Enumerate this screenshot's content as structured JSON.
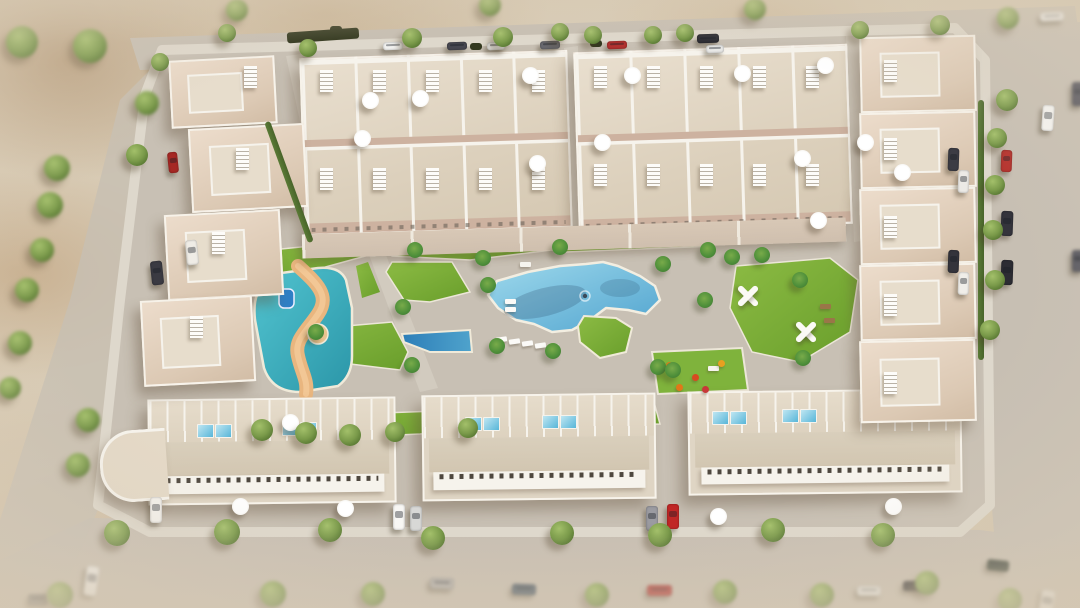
{
  "meta": {
    "title": "Aerial 3D render of a residential complex",
    "type": "architectural-visualization",
    "no_visible_text": true
  },
  "scene": {
    "description": "Bird's-eye 3D render of a gated residential development: beige townhouse rows at the top, staggered villas on the left and right edges, three long apartment blocks at the bottom, all around a central landscaped courtyard with a large lagoon-shaped pool, a turquoise kids splash pool with winding sand river and water slide, lawns with palm trees, a playground, white exercise pergolas, and perimeter streets with parked cars and trees on sandy terrain.",
    "areas": {
      "main_pool": "Large zigzag-edged communal swimming pool with tanning shelf and planted island",
      "kids_pool": "Turquoise splash lagoon with sand-colored winding river and blue water slide",
      "lap_pool": "Small dark-blue wedge pool",
      "lawns": "Green lawn patches with palm trees",
      "playground": "Playground with orange play equipment",
      "calisthenics": "White X-shaped exercise pergolas on lawn",
      "solariums": "Rooftop terraces with parasols, sun loungers and plunge pools",
      "roads": "Perimeter streets with parked cars and street trees"
    }
  },
  "colors": {
    "sand": "#d6c8b1",
    "sandDark": "#bda184",
    "road": "#c7bfb3",
    "roadLight": "#d2cabe",
    "plate": "#c8c0b4",
    "sidewalk": "#ded8cc",
    "street": "#d2cbbf",
    "building": "#e4dac9",
    "buildingLight": "#efe8db",
    "terrace": "#cdb2a0",
    "white": "#f6f3ec",
    "lawn": "#7fb23a",
    "lawnDark": "#699e2b",
    "pool": "#7cc0e0",
    "poolDeep": "#4f9fc9",
    "lagoon": "#3fb7c4",
    "river": "#e9b67f",
    "tree": "#7a9a4a",
    "palm": "#4e8f3a",
    "shadow": "rgba(95,75,55,.38)"
  },
  "buildings": {
    "top_blocks": [
      {
        "x": 302,
        "y": 54,
        "w": 264,
        "h": 174,
        "units": 5
      },
      {
        "x": 576,
        "y": 48,
        "w": 270,
        "h": 176,
        "units": 5
      }
    ],
    "patio_band": {
      "x": 302,
      "y": 226,
      "w": 544,
      "h": 24
    },
    "bottom_blocks": [
      {
        "x": 148,
        "y": 398,
        "w": 244,
        "h": 102
      },
      {
        "x": 422,
        "y": 394,
        "w": 230,
        "h": 102
      },
      {
        "x": 688,
        "y": 390,
        "w": 270,
        "h": 100
      }
    ],
    "left_villas": [
      {
        "x": 170,
        "y": 58,
        "w": 102,
        "h": 64
      },
      {
        "x": 190,
        "y": 126,
        "w": 112,
        "h": 80
      },
      {
        "x": 166,
        "y": 212,
        "w": 112,
        "h": 82
      },
      {
        "x": 142,
        "y": 298,
        "w": 108,
        "h": 82
      }
    ],
    "right_villas": [
      {
        "x": 860,
        "y": 36,
        "w": 112,
        "h": 72
      },
      {
        "x": 860,
        "y": 112,
        "w": 112,
        "h": 72
      },
      {
        "x": 860,
        "y": 188,
        "w": 112,
        "h": 72
      },
      {
        "x": 860,
        "y": 264,
        "w": 112,
        "h": 72
      },
      {
        "x": 860,
        "y": 340,
        "w": 112,
        "h": 78
      }
    ],
    "curved_end": {
      "x": 100,
      "y": 430,
      "w": 64,
      "h": 66
    }
  },
  "objects": {
    "trees_format": "[x,y,radius,blurred]",
    "trees": [
      [
        22,
        42,
        16,
        1
      ],
      [
        90,
        46,
        17,
        1
      ],
      [
        57,
        168,
        13,
        1
      ],
      [
        147,
        103,
        12,
        1
      ],
      [
        137,
        155,
        11,
        0
      ],
      [
        50,
        205,
        13,
        1
      ],
      [
        42,
        250,
        12,
        1
      ],
      [
        27,
        290,
        12,
        1
      ],
      [
        20,
        343,
        12,
        1
      ],
      [
        10,
        388,
        11,
        1
      ],
      [
        88,
        420,
        12,
        1
      ],
      [
        78,
        465,
        12,
        1
      ],
      [
        60,
        595,
        13,
        1
      ],
      [
        237,
        10,
        11,
        1
      ],
      [
        490,
        5,
        11,
        1
      ],
      [
        755,
        9,
        11,
        1
      ],
      [
        940,
        25,
        10,
        0
      ],
      [
        1008,
        18,
        11,
        1
      ],
      [
        227,
        33,
        9,
        0
      ],
      [
        412,
        38,
        10,
        0
      ],
      [
        503,
        37,
        10,
        0
      ],
      [
        560,
        32,
        9,
        0
      ],
      [
        593,
        35,
        9,
        0
      ],
      [
        653,
        35,
        9,
        0
      ],
      [
        685,
        33,
        9,
        0
      ],
      [
        160,
        62,
        9,
        0
      ],
      [
        308,
        48,
        9,
        0
      ],
      [
        860,
        30,
        9,
        0
      ],
      [
        1007,
        100,
        11,
        0
      ],
      [
        997,
        138,
        10,
        0
      ],
      [
        995,
        185,
        10,
        0
      ],
      [
        993,
        230,
        10,
        0
      ],
      [
        995,
        280,
        10,
        0
      ],
      [
        990,
        330,
        10,
        0
      ],
      [
        117,
        533,
        13,
        0
      ],
      [
        227,
        532,
        13,
        0
      ],
      [
        330,
        530,
        12,
        0
      ],
      [
        433,
        538,
        12,
        0
      ],
      [
        562,
        533,
        12,
        0
      ],
      [
        660,
        535,
        12,
        0
      ],
      [
        773,
        530,
        12,
        0
      ],
      [
        883,
        535,
        12,
        0
      ],
      [
        273,
        594,
        13,
        1
      ],
      [
        373,
        594,
        12,
        1
      ],
      [
        597,
        595,
        12,
        1
      ],
      [
        725,
        592,
        12,
        1
      ],
      [
        822,
        595,
        12,
        1
      ],
      [
        927,
        583,
        12,
        1
      ],
      [
        1010,
        600,
        12,
        1
      ],
      [
        262,
        430,
        11,
        0
      ],
      [
        306,
        433,
        11,
        0
      ],
      [
        350,
        435,
        11,
        0
      ],
      [
        395,
        432,
        10,
        0
      ],
      [
        468,
        428,
        10,
        0
      ]
    ],
    "palms": [
      [
        415,
        250
      ],
      [
        483,
        258
      ],
      [
        560,
        247
      ],
      [
        488,
        285
      ],
      [
        403,
        307
      ],
      [
        412,
        365
      ],
      [
        497,
        346
      ],
      [
        553,
        351
      ],
      [
        663,
        264
      ],
      [
        658,
        367
      ],
      [
        673,
        370
      ],
      [
        708,
        250
      ],
      [
        732,
        257
      ],
      [
        762,
        255
      ],
      [
        800,
        280
      ],
      [
        803,
        358
      ],
      [
        705,
        300
      ],
      [
        316,
        332
      ]
    ],
    "cars_format": "[x,y,w,h,color,rotationDeg,blurred]",
    "cars": [
      [
        383,
        42,
        20,
        8,
        "#f2f2f0",
        -2,
        0
      ],
      [
        447,
        42,
        20,
        8,
        "#474750",
        -2,
        0
      ],
      [
        487,
        42,
        18,
        8,
        "#ececea",
        -2,
        0
      ],
      [
        540,
        41,
        20,
        8,
        "#6a6a70",
        -2,
        0
      ],
      [
        607,
        41,
        20,
        8,
        "#b23230",
        -2,
        0
      ],
      [
        697,
        34,
        22,
        9,
        "#2e2e34",
        -2,
        0
      ],
      [
        706,
        45,
        18,
        8,
        "#e8e8e6",
        -2,
        0
      ],
      [
        1040,
        12,
        24,
        9,
        "#f4f4f2",
        -3,
        1
      ],
      [
        1042,
        105,
        12,
        26,
        "#f6f6f4",
        4,
        0
      ],
      [
        1001,
        150,
        11,
        22,
        "#b5312c",
        2,
        0
      ],
      [
        1001,
        211,
        12,
        25,
        "#34343c",
        2,
        0
      ],
      [
        1001,
        260,
        12,
        25,
        "#2c2c33",
        2,
        0
      ],
      [
        1072,
        82,
        12,
        24,
        "#50505a",
        0,
        1
      ],
      [
        1072,
        250,
        12,
        22,
        "#5a5a62",
        0,
        1
      ],
      [
        168,
        152,
        10,
        21,
        "#a62824",
        -6,
        0
      ],
      [
        186,
        240,
        12,
        25,
        "#efece6",
        -6,
        0
      ],
      [
        151,
        261,
        12,
        24,
        "#3a3a42",
        -6,
        0
      ],
      [
        948,
        148,
        11,
        23,
        "#3c3c44",
        2,
        0
      ],
      [
        958,
        170,
        11,
        23,
        "#eceae6",
        2,
        0
      ],
      [
        948,
        250,
        11,
        23,
        "#34343c",
        2,
        0
      ],
      [
        958,
        272,
        11,
        23,
        "#f0eee9",
        2,
        0
      ],
      [
        150,
        497,
        12,
        26,
        "#f4f2ee",
        0,
        0
      ],
      [
        393,
        504,
        12,
        26,
        "#f8f7f4",
        0,
        0
      ],
      [
        410,
        506,
        12,
        25,
        "#d8d8d6",
        0,
        0
      ],
      [
        646,
        506,
        12,
        25,
        "#9b9ba1",
        0,
        0
      ],
      [
        667,
        504,
        12,
        25,
        "#c02726",
        0,
        0
      ],
      [
        85,
        566,
        13,
        30,
        "#f2f1ee",
        8,
        1
      ],
      [
        430,
        578,
        24,
        11,
        "#b2b0ae",
        2,
        1
      ],
      [
        512,
        584,
        24,
        11,
        "#4c5c6c",
        2,
        1
      ],
      [
        647,
        585,
        25,
        11,
        "#b43230",
        0,
        1
      ],
      [
        857,
        586,
        24,
        10,
        "#e9e9e7",
        0,
        1
      ],
      [
        903,
        581,
        24,
        10,
        "#26262a",
        0,
        1
      ],
      [
        987,
        560,
        22,
        11,
        "#2f3a30",
        6,
        1
      ],
      [
        1040,
        590,
        14,
        26,
        "#ececea",
        10,
        1
      ],
      [
        28,
        594,
        20,
        11,
        "#777777",
        0,
        1
      ]
    ],
    "umbrellas": [
      [
        370,
        100
      ],
      [
        420,
        98
      ],
      [
        530,
        75
      ],
      [
        362,
        138
      ],
      [
        537,
        163
      ],
      [
        632,
        75
      ],
      [
        742,
        73
      ],
      [
        602,
        142
      ],
      [
        802,
        158
      ],
      [
        825,
        65
      ],
      [
        818,
        220
      ],
      [
        865,
        142
      ],
      [
        902,
        172
      ],
      [
        290,
        422
      ],
      [
        345,
        508
      ],
      [
        718,
        516
      ],
      [
        893,
        506
      ],
      [
        240,
        506
      ]
    ],
    "loungers_format": "[x,y,rotationDeg]",
    "loungers": [
      [
        496,
        337,
        -8
      ],
      [
        509,
        339,
        -8
      ],
      [
        522,
        341,
        -8
      ],
      [
        535,
        343,
        -8
      ],
      [
        548,
        345,
        -8
      ],
      [
        505,
        299,
        0
      ],
      [
        505,
        307,
        0
      ]
    ],
    "mini_pools": [
      [
        197,
        424
      ],
      [
        215,
        424
      ],
      [
        282,
        422
      ],
      [
        300,
        422
      ],
      [
        465,
        417
      ],
      [
        483,
        417
      ],
      [
        542,
        415
      ],
      [
        560,
        415
      ],
      [
        712,
        411
      ],
      [
        730,
        411
      ],
      [
        782,
        409
      ],
      [
        800,
        409
      ]
    ],
    "stair_slats": [
      [
        320,
        70
      ],
      [
        373,
        70
      ],
      [
        426,
        70
      ],
      [
        479,
        70
      ],
      [
        532,
        70
      ],
      [
        320,
        168
      ],
      [
        373,
        168
      ],
      [
        426,
        168
      ],
      [
        479,
        168
      ],
      [
        532,
        168
      ],
      [
        594,
        66
      ],
      [
        647,
        66
      ],
      [
        700,
        66
      ],
      [
        753,
        66
      ],
      [
        806,
        66
      ],
      [
        594,
        164
      ],
      [
        647,
        164
      ],
      [
        700,
        164
      ],
      [
        753,
        164
      ],
      [
        806,
        164
      ],
      [
        244,
        66
      ],
      [
        236,
        148
      ],
      [
        212,
        232
      ],
      [
        190,
        316
      ],
      [
        884,
        60
      ],
      [
        884,
        138
      ],
      [
        884,
        216
      ],
      [
        884,
        294
      ],
      [
        884,
        372
      ]
    ],
    "hedges_format": "[x,y,w,h,rotationDeg,dark]",
    "hedges": [
      [
        287,
        30,
        72,
        11,
        -4,
        1
      ],
      [
        286,
        118,
        6,
        128,
        -20,
        0
      ],
      [
        978,
        100,
        6,
        260,
        0,
        0
      ],
      [
        470,
        43,
        12,
        7,
        0,
        1
      ],
      [
        590,
        40,
        12,
        7,
        0,
        1
      ],
      [
        330,
        26,
        12,
        7,
        0,
        1
      ]
    ],
    "benches_format": "[x,y,color]",
    "benches": [
      [
        520,
        262,
        "#f6f4ee"
      ],
      [
        708,
        366,
        "#f6f4ee"
      ],
      [
        820,
        304,
        "#9a7648"
      ],
      [
        824,
        318,
        "#9a7648"
      ]
    ],
    "play_dots_format": "[x,y,color]",
    "play_dots": [
      [
        666,
        362,
        "#e07818"
      ],
      [
        692,
        374,
        "#d84a20"
      ],
      [
        718,
        360,
        "#e8a020"
      ],
      [
        702,
        386,
        "#c83838"
      ],
      [
        676,
        384,
        "#e07818"
      ]
    ],
    "exercise_pergolas": [
      [
        748,
        296
      ],
      [
        806,
        332
      ]
    ]
  }
}
